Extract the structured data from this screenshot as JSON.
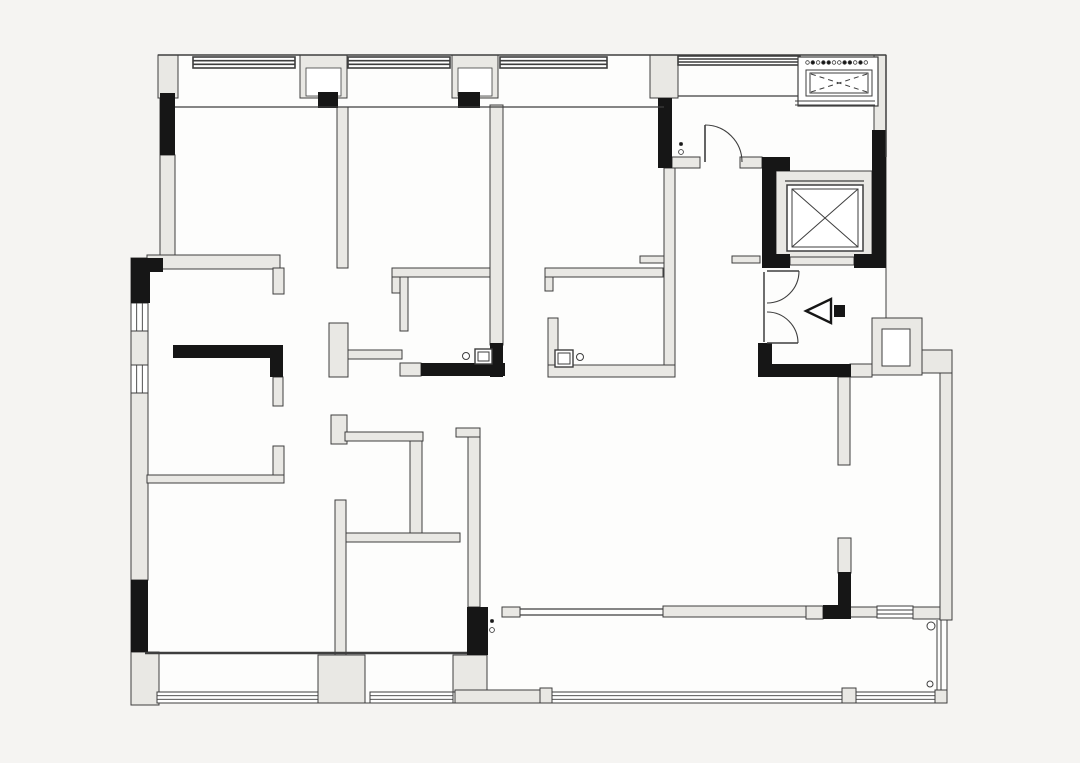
{
  "canvas": {
    "width": 1080,
    "height": 763,
    "bg": "#f5f4f2",
    "interior": "#fdfdfc",
    "wall_fill": "#e9e8e4",
    "stroke": "#3e3e3e",
    "black": "#161616",
    "window_fill": "#ffffff"
  },
  "plan": {
    "outline": "M160,55 H886 V318 H922 V350 H952 V620 H947 V703 H131 V258 H160 Z",
    "walls": [
      [
        158,
        55,
        20,
        43
      ],
      [
        300,
        55,
        47,
        43
      ],
      [
        452,
        55,
        46,
        43
      ],
      [
        650,
        55,
        28,
        43
      ],
      [
        874,
        55,
        12,
        77
      ],
      [
        160,
        155,
        15,
        103
      ],
      [
        337,
        107,
        11,
        161
      ],
      [
        147,
        255,
        133,
        14
      ],
      [
        273,
        268,
        11,
        26
      ],
      [
        131,
        330,
        17,
        36
      ],
      [
        131,
        393,
        17,
        187
      ],
      [
        131,
        652,
        28,
        53
      ],
      [
        318,
        655,
        47,
        48
      ],
      [
        453,
        655,
        34,
        37
      ],
      [
        329,
        323,
        19,
        54
      ],
      [
        348,
        350,
        54,
        9
      ],
      [
        273,
        377,
        10,
        29
      ],
      [
        273,
        446,
        11,
        36
      ],
      [
        147,
        475,
        137,
        8
      ],
      [
        331,
        415,
        16,
        29
      ],
      [
        345,
        432,
        78,
        9
      ],
      [
        410,
        441,
        12,
        92
      ],
      [
        345,
        533,
        115,
        9
      ],
      [
        335,
        500,
        11,
        155
      ],
      [
        456,
        428,
        24,
        9
      ],
      [
        468,
        437,
        12,
        170
      ],
      [
        392,
        268,
        100,
        9
      ],
      [
        392,
        277,
        9,
        16
      ],
      [
        400,
        277,
        8,
        54
      ],
      [
        400,
        363,
        21,
        13
      ],
      [
        490,
        105,
        13,
        240
      ],
      [
        545,
        268,
        118,
        9
      ],
      [
        545,
        277,
        8,
        14
      ],
      [
        548,
        318,
        10,
        47
      ],
      [
        548,
        365,
        127,
        12
      ],
      [
        664,
        168,
        11,
        197
      ],
      [
        640,
        256,
        24,
        7
      ],
      [
        732,
        256,
        28,
        7
      ],
      [
        672,
        157,
        28,
        11
      ],
      [
        740,
        157,
        22,
        11
      ],
      [
        776,
        171,
        96,
        86
      ],
      [
        790,
        257,
        64,
        8
      ],
      [
        850,
        364,
        22,
        13
      ],
      [
        872,
        318,
        50,
        57
      ],
      [
        922,
        350,
        30,
        23
      ],
      [
        940,
        373,
        12,
        247
      ],
      [
        838,
        377,
        12,
        88
      ],
      [
        838,
        538,
        13,
        35
      ],
      [
        502,
        607,
        18,
        10
      ],
      [
        806,
        606,
        17,
        13
      ],
      [
        850,
        607,
        27,
        10
      ],
      [
        913,
        607,
        27,
        12
      ],
      [
        663,
        606,
        143,
        11
      ],
      [
        455,
        690,
        85,
        13
      ],
      [
        540,
        688,
        12,
        15
      ],
      [
        842,
        688,
        14,
        15
      ],
      [
        935,
        690,
        12,
        13
      ]
    ],
    "black_walls": [
      [
        160,
        93,
        15,
        62
      ],
      [
        318,
        92,
        20,
        16
      ],
      [
        458,
        92,
        22,
        16
      ],
      [
        658,
        98,
        14,
        70
      ],
      [
        872,
        130,
        14,
        28
      ],
      [
        762,
        157,
        28,
        14
      ],
      [
        762,
        157,
        14,
        111
      ],
      [
        872,
        157,
        14,
        111
      ],
      [
        762,
        254,
        28,
        14
      ],
      [
        854,
        254,
        32,
        14
      ],
      [
        758,
        343,
        14,
        34
      ],
      [
        758,
        364,
        93,
        13
      ],
      [
        823,
        605,
        28,
        14
      ],
      [
        838,
        572,
        13,
        35
      ],
      [
        467,
        607,
        21,
        48
      ],
      [
        131,
        258,
        19,
        45
      ],
      [
        131,
        258,
        32,
        14
      ],
      [
        131,
        580,
        17,
        72
      ],
      [
        173,
        345,
        110,
        13
      ],
      [
        270,
        345,
        13,
        32
      ],
      [
        421,
        363,
        84,
        13
      ],
      [
        490,
        343,
        13,
        34
      ]
    ],
    "inner_whites": [
      [
        306,
        68,
        35,
        28
      ],
      [
        458,
        68,
        34,
        28
      ]
    ],
    "windows": [
      {
        "x": 193,
        "y": 57,
        "w": 102,
        "h": 11,
        "o": "h",
        "bold": true
      },
      {
        "x": 348,
        "y": 57,
        "w": 102,
        "h": 11,
        "o": "h",
        "bold": true
      },
      {
        "x": 500,
        "y": 57,
        "w": 107,
        "h": 11,
        "o": "h",
        "bold": true
      },
      {
        "x": 678,
        "y": 56,
        "w": 122,
        "h": 9,
        "o": "h",
        "bold": true
      },
      {
        "x": 131,
        "y": 303,
        "w": 17,
        "h": 28,
        "o": "v",
        "bold": false
      },
      {
        "x": 131,
        "y": 365,
        "w": 17,
        "h": 28,
        "o": "v",
        "bold": false
      },
      {
        "x": 157,
        "y": 692,
        "w": 161,
        "h": 11,
        "o": "h",
        "bold": false
      },
      {
        "x": 370,
        "y": 692,
        "w": 83,
        "h": 11,
        "o": "h",
        "bold": false
      },
      {
        "x": 552,
        "y": 692,
        "w": 290,
        "h": 11,
        "o": "h",
        "bold": false
      },
      {
        "x": 856,
        "y": 692,
        "w": 79,
        "h": 11,
        "o": "h",
        "bold": false
      },
      {
        "x": 877,
        "y": 606,
        "w": 36,
        "h": 12,
        "o": "h",
        "bold": false
      }
    ],
    "lines": [
      [
        158,
        55,
        886,
        55,
        1.5
      ],
      [
        886,
        55,
        886,
        157,
        1.5
      ],
      [
        175,
        107,
        664,
        107,
        1.2
      ],
      [
        678,
        96,
        798,
        96,
        1.2
      ],
      [
        145,
        653,
        467,
        653,
        2.5
      ],
      [
        520,
        609,
        663,
        609,
        1.2
      ],
      [
        520,
        615,
        663,
        615,
        1.2
      ],
      [
        937,
        620,
        937,
        690,
        1
      ],
      [
        941,
        620,
        941,
        690,
        1
      ],
      [
        764,
        272,
        764,
        342,
        1.5
      ]
    ],
    "doors": [
      {
        "panel": [
          705,
          125,
          705,
          162
        ],
        "arc": "M705,125 A37,37 0 0 1 742,162"
      },
      {
        "panel": [
          767,
          271,
          799,
          271
        ],
        "arc": "M799,271 A32,32 0 0 1 767,303"
      },
      {
        "panel": [
          767,
          343,
          798,
          343
        ],
        "arc": "M798,343 A31,31 0 0 0 767,312"
      }
    ],
    "closet_inner": [
      882,
      329,
      28,
      37
    ],
    "elevator": {
      "box": [
        787,
        185,
        76,
        66
      ],
      "inner": [
        792,
        189,
        66,
        58
      ],
      "lintel": [
        785,
        181,
        864,
        181
      ]
    },
    "equipment": {
      "outer": [
        798,
        57,
        80,
        49
      ],
      "inner1": [
        806,
        70,
        66,
        26
      ],
      "inner2": [
        810,
        73,
        58,
        20
      ],
      "dash": [
        [
          811,
          74,
          867,
          92
        ],
        [
          811,
          92,
          867,
          74
        ]
      ],
      "base_lines": [
        [
          795,
          101,
          875,
          101
        ],
        [
          795,
          105,
          875,
          105
        ]
      ],
      "dots_x0": 807.5,
      "dots_step": 5.3,
      "dots_y": 62.5,
      "dots_n": 12,
      "dots_filled": [
        1,
        3,
        4,
        7,
        8,
        10
      ]
    },
    "fixtures": [
      {
        "outer": [
          475,
          349,
          17,
          15
        ],
        "inner": [
          478,
          352,
          11,
          9
        ]
      },
      {
        "outer": [
          555,
          350,
          18,
          17
        ],
        "inner": [
          558,
          353,
          12,
          11
        ]
      }
    ],
    "circles": [
      [
        466,
        356,
        3.5
      ],
      [
        580,
        357,
        3.5
      ],
      [
        931,
        626,
        4
      ],
      [
        930,
        684,
        3
      ]
    ],
    "hinge_dots": [
      [
        681,
        144,
        1
      ],
      [
        681,
        152,
        0
      ],
      [
        492,
        621,
        1
      ],
      [
        492,
        630,
        0
      ]
    ],
    "entry_arrow": {
      "triangle": "806,311 831,299 831,323",
      "square": [
        834,
        305,
        11,
        12
      ]
    }
  }
}
